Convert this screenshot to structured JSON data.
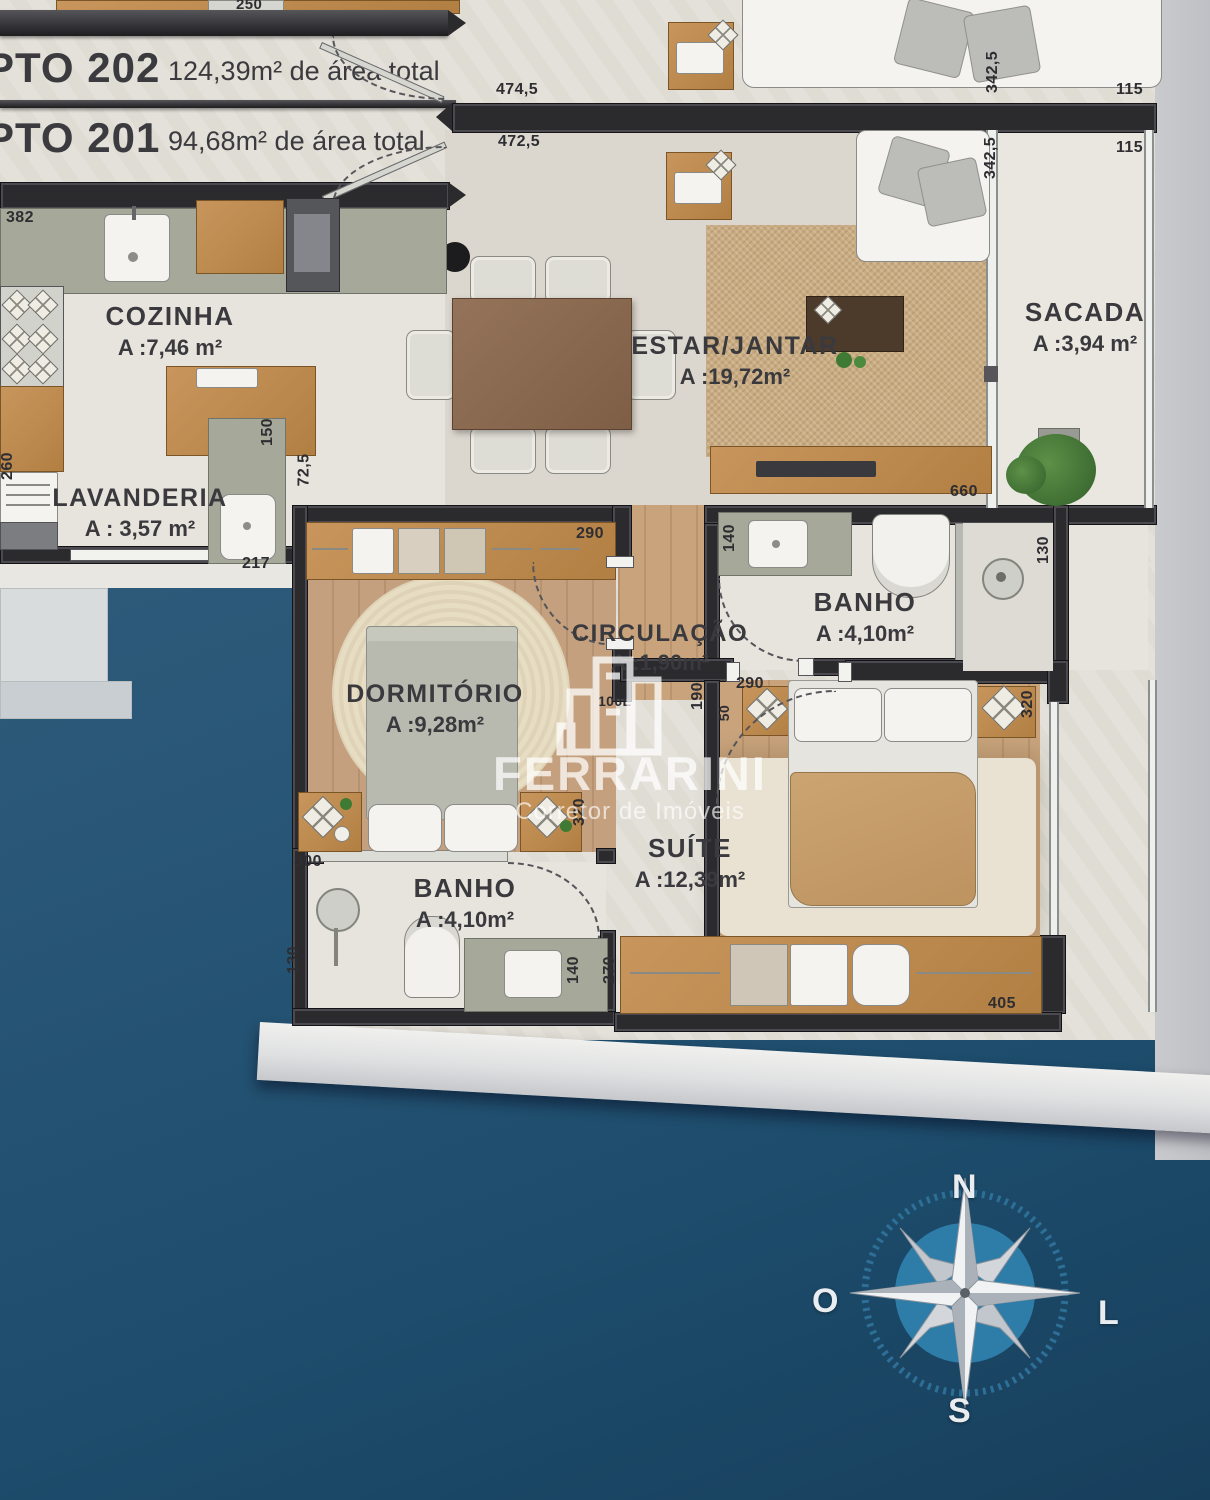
{
  "banners": {
    "b202": {
      "unit": "PTO 202",
      "area": "124,39m² de área total"
    },
    "b201": {
      "unit": "PTO 201",
      "area": "94,68m² de área total"
    }
  },
  "rooms": {
    "cozinha": {
      "name": "COZINHA",
      "area": "A :7,46 m²"
    },
    "lavanderia": {
      "name": "LAVANDERIA",
      "area": "A : 3,57 m²"
    },
    "estar_jantar": {
      "name": "ESTAR/JANTAR",
      "area": "A :19,72m²"
    },
    "sacada": {
      "name": "SACADA",
      "area": "A :3,94 m²"
    },
    "circulacao": {
      "name": "CIRCULAÇÃO",
      "area": "A :1,90m²"
    },
    "banho_superior": {
      "name": "BANHO",
      "area": "A :4,10m²"
    },
    "dormitorio": {
      "name": "DORMITÓRIO",
      "area": "A :9,28m²"
    },
    "suite": {
      "name": "SUÍTE",
      "area": "A :12,39m²"
    },
    "banho_inferior": {
      "name": "BANHO",
      "area": "A :4,10m²"
    }
  },
  "dims": {
    "wardrobe_250": "250",
    "top_4745": "474,5",
    "top_4725": "472,5",
    "right_3425_sup": "342,5",
    "right_115_sup": "115",
    "right_3425_inf": "342,5",
    "right_115_inf": "115",
    "coz_382": "382",
    "coz_150": "150",
    "lav_260": "260",
    "lav_725": "72,5",
    "lav_217": "217",
    "estar_660": "660",
    "dorm_290": "290",
    "banho_sup_140": "140",
    "banho_sup_130": "130",
    "circ_190": "190",
    "porta_100l": "100L",
    "suite_290": "290",
    "suite_50": "50",
    "suite_320": "320",
    "dorm_320": "320",
    "banho_inf_300": "300",
    "banho_inf_130": "130",
    "banho_inf_140": "140",
    "suite_270": "270",
    "suite_405": "405"
  },
  "watermark": {
    "brand": "FERRARINI",
    "tagline": "Corretor de Imóveis"
  },
  "compass": {
    "north": "N",
    "south": "S",
    "west": "O",
    "east": "L"
  },
  "colors": {
    "page_blue": "#24546f",
    "paper": "#e4e1da",
    "wall": "#2b2b2e",
    "wood_floor": "#c8a37c",
    "wood_furniture": "#bd8a52",
    "counter_green": "#a6a99a",
    "compass_blue": "#2e7ca8"
  }
}
